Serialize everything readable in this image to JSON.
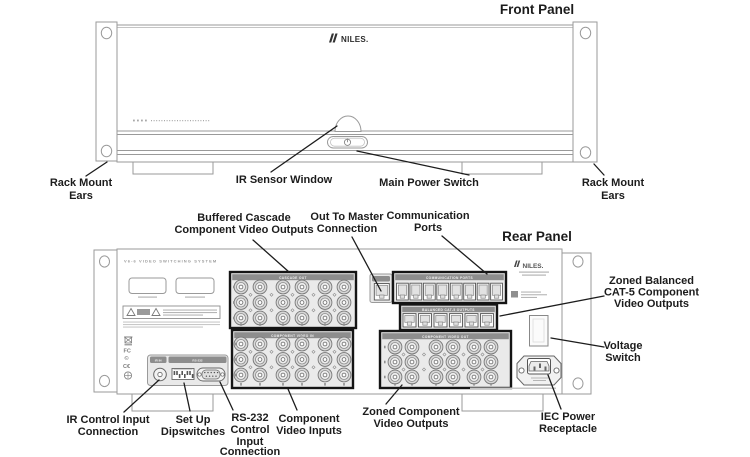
{
  "colors": {
    "device_outline": "#9a9a9a",
    "connector_box_border": "#151515",
    "connector_block_fill": "#eaeaea",
    "header_strip": "#8d8d8d",
    "label_text": "#1c1c1c",
    "background": "#ffffff"
  },
  "icons": {
    "power_icon": "circle-with-bar",
    "niles_leaf_icon": "double-leaf",
    "warning_triangle_icon": "triangle",
    "weee_icon": "crossed-out-bin",
    "fcc_mark": "FC",
    "copyright_mark": "©",
    "ce_mark": "C€",
    "cert_icon": "circle-cross"
  },
  "front_panel": {
    "title": "Front Panel",
    "brand": "NILES.",
    "callouts": {
      "rack_mount_ears_left": {
        "lines": [
          "Rack Mount",
          "Ears"
        ]
      },
      "ir_sensor_window": {
        "lines": [
          "IR Sensor Window"
        ]
      },
      "main_power_switch": {
        "lines": [
          "Main Power Switch"
        ]
      },
      "rack_mount_ears_right": {
        "lines": [
          "Rack Mount",
          "Ears"
        ]
      }
    }
  },
  "rear_panel": {
    "title": "Rear Panel",
    "brand": "NILES.",
    "model_text": "V6-6 VIDEO SWITCHING SYSTEM",
    "strip_labels": {
      "cascade": "CASCADE OUT",
      "component_in": "COMPONENT VIDEO IN",
      "communication": "COMMUNICATION PORTS",
      "balanced": "BALANCED CAT-5 OUTPUTS",
      "zoned_out": "COMPONENT VIDEO OUT",
      "ir_in": "IR IN",
      "rs232": "RS-232"
    },
    "connector_counts": {
      "buffered_cascade_bnc": 18,
      "component_video_in_bnc": 18,
      "zoned_component_out_bnc": 18,
      "communication_ports": 8,
      "balanced_cat5_outputs": 6,
      "out_to_master": 1
    },
    "callouts": {
      "buffered_cascade": {
        "lines": [
          "Buffered Cascade",
          "Component Video Outputs"
        ]
      },
      "out_to_master": {
        "lines": [
          "Out To Master",
          "Connection"
        ]
      },
      "communication_ports": {
        "lines": [
          "Communication",
          "Ports"
        ]
      },
      "zoned_balanced": {
        "lines": [
          "Zoned Balanced",
          "CAT-5 Component",
          "Video Outputs"
        ]
      },
      "voltage_switch": {
        "lines": [
          "Voltage",
          "Switch"
        ]
      },
      "iec_power": {
        "lines": [
          "IEC Power",
          "Receptacle"
        ]
      },
      "zoned_component": {
        "lines": [
          "Zoned Component",
          "Video Outputs"
        ]
      },
      "component_inputs": {
        "lines": [
          "Component",
          "Video Inputs"
        ]
      },
      "rs232_control": {
        "lines": [
          "RS-232",
          "Control",
          "Input",
          "Connection"
        ]
      },
      "setup_dipswitches": {
        "lines": [
          "Set Up",
          "Dipswitches"
        ]
      },
      "ir_control": {
        "lines": [
          "IR Control Input",
          "Connection"
        ]
      }
    }
  }
}
